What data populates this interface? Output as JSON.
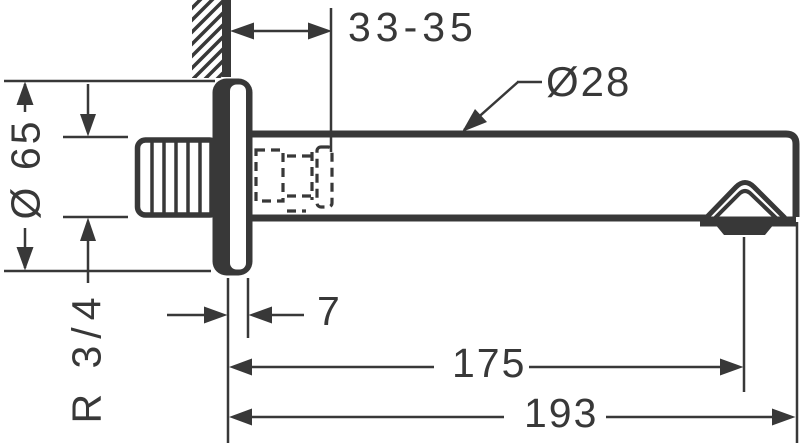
{
  "drawing": {
    "subject": "wall-mounted-bath-spout",
    "stroke_color": "#383838",
    "background_color": "#ffffff",
    "dimensions": {
      "wall_clearance": "33-35",
      "spout_diameter": "Ø28",
      "escutcheon_diameter": "Ø 65",
      "connection_thread": "R 3/4",
      "escutcheon_depth": "7",
      "length_to_outlet": "175",
      "total_length": "193"
    }
  }
}
